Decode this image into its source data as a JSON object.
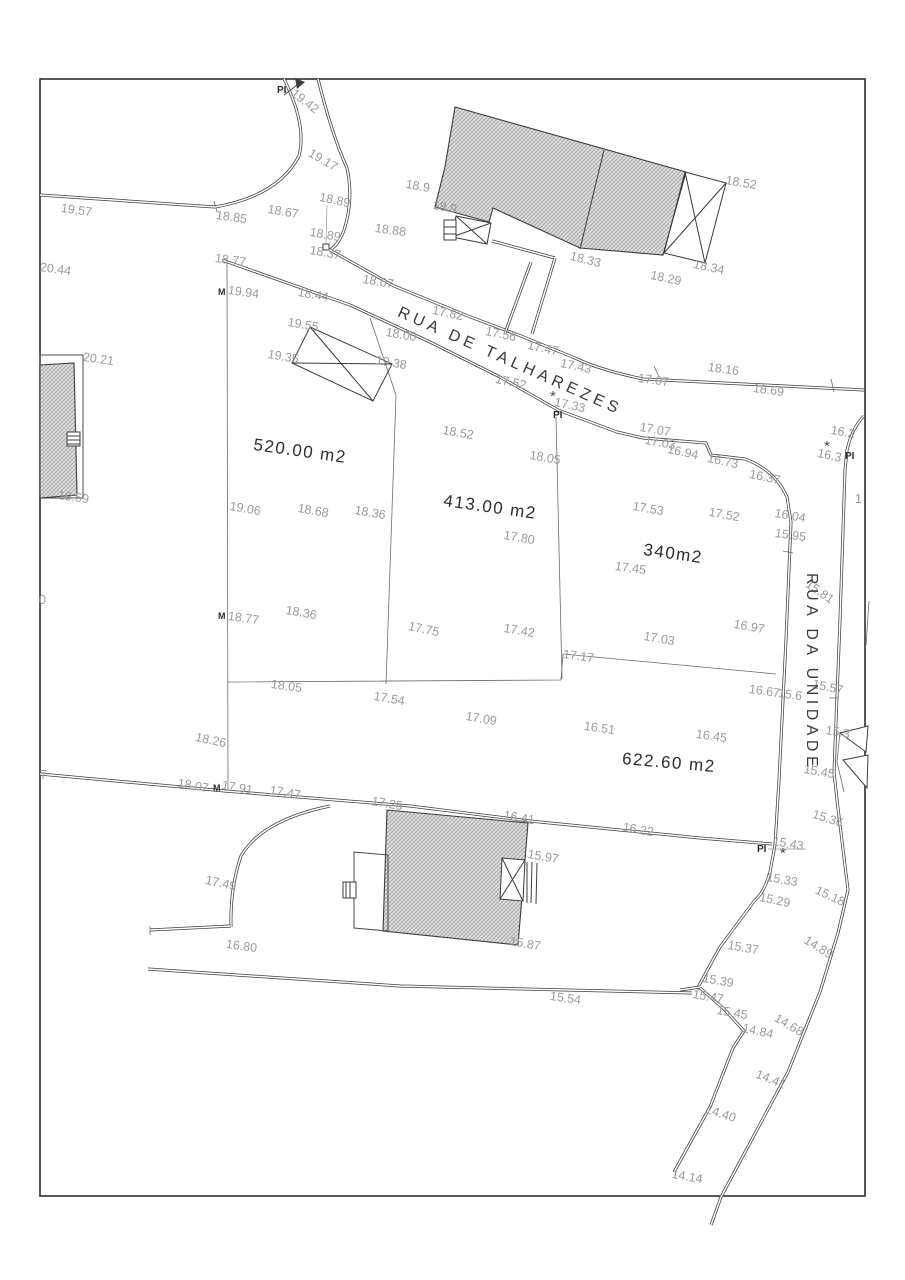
{
  "drawing": {
    "kind": "cadastral survey plan",
    "streets": [
      "RUA DE TALHAREZES",
      "RUA DA UNIDADE"
    ],
    "parcel_areas": [
      "520.00 m2",
      "413.00 m2",
      "340m2",
      "622.60 m2"
    ]
  },
  "labels": [
    {
      "t": "19.42",
      "x": 297,
      "y": 86,
      "r": 38,
      "k": "elevation"
    },
    {
      "t": "PI",
      "x": 277,
      "y": 85,
      "r": 0,
      "k": "pi"
    },
    {
      "t": "19.17",
      "x": 313,
      "y": 146,
      "r": 30,
      "k": "elevation"
    },
    {
      "t": "19.57",
      "x": 62,
      "y": 201,
      "r": 8,
      "k": "elevation"
    },
    {
      "t": "18.85",
      "x": 217,
      "y": 208,
      "r": 8,
      "k": "elevation"
    },
    {
      "t": "18.67",
      "x": 269,
      "y": 202,
      "r": 10,
      "k": "elevation"
    },
    {
      "t": "18.89",
      "x": 321,
      "y": 190,
      "r": 12,
      "k": "elevation"
    },
    {
      "t": "18.88",
      "x": 376,
      "y": 221,
      "r": 8,
      "k": "elevation"
    },
    {
      "t": "18.89",
      "x": 311,
      "y": 225,
      "r": 10,
      "k": "elevation"
    },
    {
      "t": "18.37",
      "x": 311,
      "y": 243,
      "r": 10,
      "k": "elevation"
    },
    {
      "t": "20.44",
      "x": 41,
      "y": 260,
      "r": 8,
      "k": "elevation"
    },
    {
      "t": "18.77",
      "x": 216,
      "y": 251,
      "r": 8,
      "k": "elevation"
    },
    {
      "t": "M",
      "x": 218,
      "y": 287,
      "r": 0,
      "k": "m"
    },
    {
      "t": "19.94",
      "x": 229,
      "y": 283,
      "r": 8,
      "k": "elevation"
    },
    {
      "t": "18.44",
      "x": 299,
      "y": 285,
      "r": 10,
      "k": "elevation"
    },
    {
      "t": "18.07",
      "x": 364,
      "y": 272,
      "r": 10,
      "k": "elevation"
    },
    {
      "t": "19.55",
      "x": 289,
      "y": 315,
      "r": 10,
      "k": "elevation"
    },
    {
      "t": "17.82",
      "x": 434,
      "y": 303,
      "r": 12,
      "k": "elevation"
    },
    {
      "t": "18.00",
      "x": 387,
      "y": 325,
      "r": 10,
      "k": "elevation"
    },
    {
      "t": "19.35",
      "x": 269,
      "y": 347,
      "r": 10,
      "k": "elevation"
    },
    {
      "t": "19.38",
      "x": 377,
      "y": 353,
      "r": 10,
      "k": "elevation"
    },
    {
      "t": "18.9",
      "x": 407,
      "y": 177,
      "r": 10,
      "k": "elevation"
    },
    {
      "t": "18.9",
      "x": 434,
      "y": 198,
      "r": 10,
      "k": "elevation"
    },
    {
      "t": "18.52",
      "x": 727,
      "y": 173,
      "r": 10,
      "k": "elevation"
    },
    {
      "t": "18.33",
      "x": 572,
      "y": 249,
      "r": 14,
      "k": "elevation"
    },
    {
      "t": "18.29",
      "x": 652,
      "y": 268,
      "r": 12,
      "k": "elevation"
    },
    {
      "t": "18.34",
      "x": 695,
      "y": 257,
      "r": 12,
      "k": "elevation"
    },
    {
      "t": "17.56",
      "x": 487,
      "y": 324,
      "r": 12,
      "k": "elevation"
    },
    {
      "t": "17.47",
      "x": 529,
      "y": 338,
      "r": 12,
      "k": "elevation"
    },
    {
      "t": "17.43",
      "x": 562,
      "y": 356,
      "r": 12,
      "k": "elevation"
    },
    {
      "t": "17.07",
      "x": 639,
      "y": 371,
      "r": 8,
      "k": "elevation"
    },
    {
      "t": "18.16",
      "x": 709,
      "y": 360,
      "r": 8,
      "k": "elevation"
    },
    {
      "t": "18.69",
      "x": 754,
      "y": 381,
      "r": 8,
      "k": "elevation"
    },
    {
      "t": "17.52",
      "x": 497,
      "y": 372,
      "r": 12,
      "k": "elevation"
    },
    {
      "t": "*",
      "x": 550,
      "y": 388,
      "r": 0,
      "k": "star"
    },
    {
      "t": "17.33",
      "x": 556,
      "y": 395,
      "r": 12,
      "k": "elevation"
    },
    {
      "t": "PI",
      "x": 553,
      "y": 410,
      "r": 0,
      "k": "pi"
    },
    {
      "t": "18.52",
      "x": 444,
      "y": 423,
      "r": 10,
      "k": "elevation"
    },
    {
      "t": "17.07",
      "x": 641,
      "y": 420,
      "r": 10,
      "k": "elevation"
    },
    {
      "t": "17.03",
      "x": 646,
      "y": 433,
      "r": 10,
      "k": "elevation"
    },
    {
      "t": "16.94",
      "x": 669,
      "y": 442,
      "r": 12,
      "k": "elevation"
    },
    {
      "t": "16.73",
      "x": 709,
      "y": 451,
      "r": 12,
      "k": "elevation"
    },
    {
      "t": "16.37",
      "x": 751,
      "y": 467,
      "r": 12,
      "k": "elevation"
    },
    {
      "t": "16.04",
      "x": 776,
      "y": 506,
      "r": 10,
      "k": "elevation"
    },
    {
      "t": "15.95",
      "x": 776,
      "y": 526,
      "r": 8,
      "k": "elevation"
    },
    {
      "t": "16.2",
      "x": 832,
      "y": 423,
      "r": 10,
      "k": "elevation"
    },
    {
      "t": "*",
      "x": 824,
      "y": 438,
      "r": 0,
      "k": "star"
    },
    {
      "t": "16.3",
      "x": 819,
      "y": 446,
      "r": 12,
      "k": "elevation"
    },
    {
      "t": "PI",
      "x": 845,
      "y": 451,
      "r": 0,
      "k": "pi"
    },
    {
      "t": "1",
      "x": 855,
      "y": 492,
      "r": 0,
      "k": "elevation"
    },
    {
      "t": "520.00 m2",
      "x": 255,
      "y": 435,
      "r": 8,
      "k": "area"
    },
    {
      "t": "20.21",
      "x": 84,
      "y": 350,
      "r": 8,
      "k": "elevation"
    },
    {
      "t": "19.59",
      "x": 59,
      "y": 488,
      "r": 8,
      "k": "elevation"
    },
    {
      "t": "19.06",
      "x": 231,
      "y": 499,
      "r": 10,
      "k": "elevation"
    },
    {
      "t": "18.68",
      "x": 299,
      "y": 501,
      "r": 10,
      "k": "elevation"
    },
    {
      "t": "18.36",
      "x": 356,
      "y": 503,
      "r": 10,
      "k": "elevation"
    },
    {
      "t": "413.00 m2",
      "x": 445,
      "y": 491,
      "r": 8,
      "k": "area"
    },
    {
      "t": "18.05",
      "x": 531,
      "y": 448,
      "r": 10,
      "k": "elevation"
    },
    {
      "t": "17.80",
      "x": 505,
      "y": 528,
      "r": 10,
      "k": "elevation"
    },
    {
      "t": "17.53",
      "x": 634,
      "y": 499,
      "r": 10,
      "k": "elevation"
    },
    {
      "t": "17.52",
      "x": 710,
      "y": 505,
      "r": 10,
      "k": "elevation"
    },
    {
      "t": "340m2",
      "x": 645,
      "y": 540,
      "r": 8,
      "k": "area"
    },
    {
      "t": "17.45",
      "x": 616,
      "y": 559,
      "r": 8,
      "k": "elevation"
    },
    {
      "t": "M",
      "x": 218,
      "y": 611,
      "r": 0,
      "k": "m"
    },
    {
      "t": "18.77",
      "x": 229,
      "y": 609,
      "r": 8,
      "k": "elevation"
    },
    {
      "t": "18.36",
      "x": 287,
      "y": 603,
      "r": 10,
      "k": "elevation"
    },
    {
      "t": "17.75",
      "x": 410,
      "y": 619,
      "r": 12,
      "k": "elevation"
    },
    {
      "t": "17.42",
      "x": 505,
      "y": 621,
      "r": 10,
      "k": "elevation"
    },
    {
      "t": "18.05",
      "x": 272,
      "y": 677,
      "r": 8,
      "k": "elevation"
    },
    {
      "t": "17.54",
      "x": 375,
      "y": 689,
      "r": 10,
      "k": "elevation"
    },
    {
      "t": "17.09",
      "x": 467,
      "y": 709,
      "r": 10,
      "k": "elevation"
    },
    {
      "t": "18.26",
      "x": 197,
      "y": 730,
      "r": 12,
      "k": "elevation"
    },
    {
      "t": "17.17",
      "x": 564,
      "y": 647,
      "r": 8,
      "k": "elevation"
    },
    {
      "t": "17.03",
      "x": 645,
      "y": 629,
      "r": 10,
      "k": "elevation"
    },
    {
      "t": "16.97",
      "x": 735,
      "y": 617,
      "r": 10,
      "k": "elevation"
    },
    {
      "t": "16.67",
      "x": 750,
      "y": 682,
      "r": 8,
      "k": "elevation"
    },
    {
      "t": "15.6",
      "x": 779,
      "y": 686,
      "r": 8,
      "k": "elevation"
    },
    {
      "t": "15.57",
      "x": 814,
      "y": 677,
      "r": 12,
      "k": "elevation"
    },
    {
      "t": "15.81",
      "x": 811,
      "y": 577,
      "r": 35,
      "k": "elevation"
    },
    {
      "t": "16.51",
      "x": 585,
      "y": 719,
      "r": 8,
      "k": "elevation"
    },
    {
      "t": "16.45",
      "x": 697,
      "y": 727,
      "r": 8,
      "k": "elevation"
    },
    {
      "t": "622.60 m2",
      "x": 623,
      "y": 749,
      "r": 5,
      "k": "area"
    },
    {
      "t": "15.3",
      "x": 827,
      "y": 723,
      "r": 10,
      "k": "elevation"
    },
    {
      "t": "15.45",
      "x": 805,
      "y": 762,
      "r": 10,
      "k": "elevation"
    },
    {
      "t": "15.36",
      "x": 815,
      "y": 807,
      "r": 18,
      "k": "elevation"
    },
    {
      "t": "15.43",
      "x": 774,
      "y": 834,
      "r": 10,
      "k": "elevation"
    },
    {
      "t": "PI",
      "x": 757,
      "y": 844,
      "r": 0,
      "k": "pi"
    },
    {
      "t": "*",
      "x": 780,
      "y": 845,
      "r": 0,
      "k": "star"
    },
    {
      "t": "15.33",
      "x": 768,
      "y": 870,
      "r": 10,
      "k": "elevation"
    },
    {
      "t": "15.29",
      "x": 761,
      "y": 890,
      "r": 12,
      "k": "elevation"
    },
    {
      "t": "15.18",
      "x": 819,
      "y": 883,
      "r": 25,
      "k": "elevation"
    },
    {
      "t": "15.37",
      "x": 729,
      "y": 938,
      "r": 10,
      "k": "elevation"
    },
    {
      "t": "14.89",
      "x": 809,
      "y": 933,
      "r": 32,
      "k": "elevation"
    },
    {
      "t": "15.39",
      "x": 704,
      "y": 971,
      "r": 10,
      "k": "elevation"
    },
    {
      "t": "15.47",
      "x": 694,
      "y": 987,
      "r": 10,
      "k": "elevation"
    },
    {
      "t": "15.45",
      "x": 718,
      "y": 1003,
      "r": 10,
      "k": "elevation"
    },
    {
      "t": "14.84",
      "x": 744,
      "y": 1021,
      "r": 12,
      "k": "elevation"
    },
    {
      "t": "14.68",
      "x": 779,
      "y": 1011,
      "r": 30,
      "k": "elevation"
    },
    {
      "t": "14.41",
      "x": 759,
      "y": 1067,
      "r": 22,
      "k": "elevation"
    },
    {
      "t": "14.40",
      "x": 708,
      "y": 1102,
      "r": 18,
      "k": "elevation"
    },
    {
      "t": "14.14",
      "x": 673,
      "y": 1167,
      "r": 10,
      "k": "elevation"
    },
    {
      "t": "18.07",
      "x": 179,
      "y": 776,
      "r": 10,
      "k": "elevation"
    },
    {
      "t": "M",
      "x": 213,
      "y": 783,
      "r": 0,
      "k": "m"
    },
    {
      "t": "17.91",
      "x": 223,
      "y": 778,
      "r": 10,
      "k": "elevation"
    },
    {
      "t": "17.47",
      "x": 271,
      "y": 783,
      "r": 10,
      "k": "elevation"
    },
    {
      "t": "17.25",
      "x": 373,
      "y": 794,
      "r": 10,
      "k": "elevation"
    },
    {
      "t": "17.49",
      "x": 207,
      "y": 873,
      "r": 12,
      "k": "elevation"
    },
    {
      "t": "16.80",
      "x": 227,
      "y": 937,
      "r": 8,
      "k": "elevation"
    },
    {
      "t": "16.41",
      "x": 505,
      "y": 808,
      "r": 10,
      "k": "elevation"
    },
    {
      "t": "16.22",
      "x": 624,
      "y": 820,
      "r": 10,
      "k": "elevation"
    },
    {
      "t": "15.97",
      "x": 529,
      "y": 847,
      "r": 10,
      "k": "elevation"
    },
    {
      "t": "15.87",
      "x": 511,
      "y": 934,
      "r": 10,
      "k": "elevation"
    },
    {
      "t": "15.54",
      "x": 551,
      "y": 989,
      "r": 8,
      "k": "elevation"
    },
    {
      "t": "0",
      "x": 39,
      "y": 593,
      "r": 0,
      "k": "elevation"
    },
    {
      "t": "7",
      "x": 40,
      "y": 768,
      "r": 0,
      "k": "elevation"
    },
    {
      "t": "RUA DE TALHAREZES",
      "x": 402,
      "y": 304,
      "r": 24,
      "k": "street"
    },
    {
      "t": "RUA DA UNIDADE",
      "x": 820,
      "y": 573,
      "r": 90,
      "k": "street"
    }
  ]
}
